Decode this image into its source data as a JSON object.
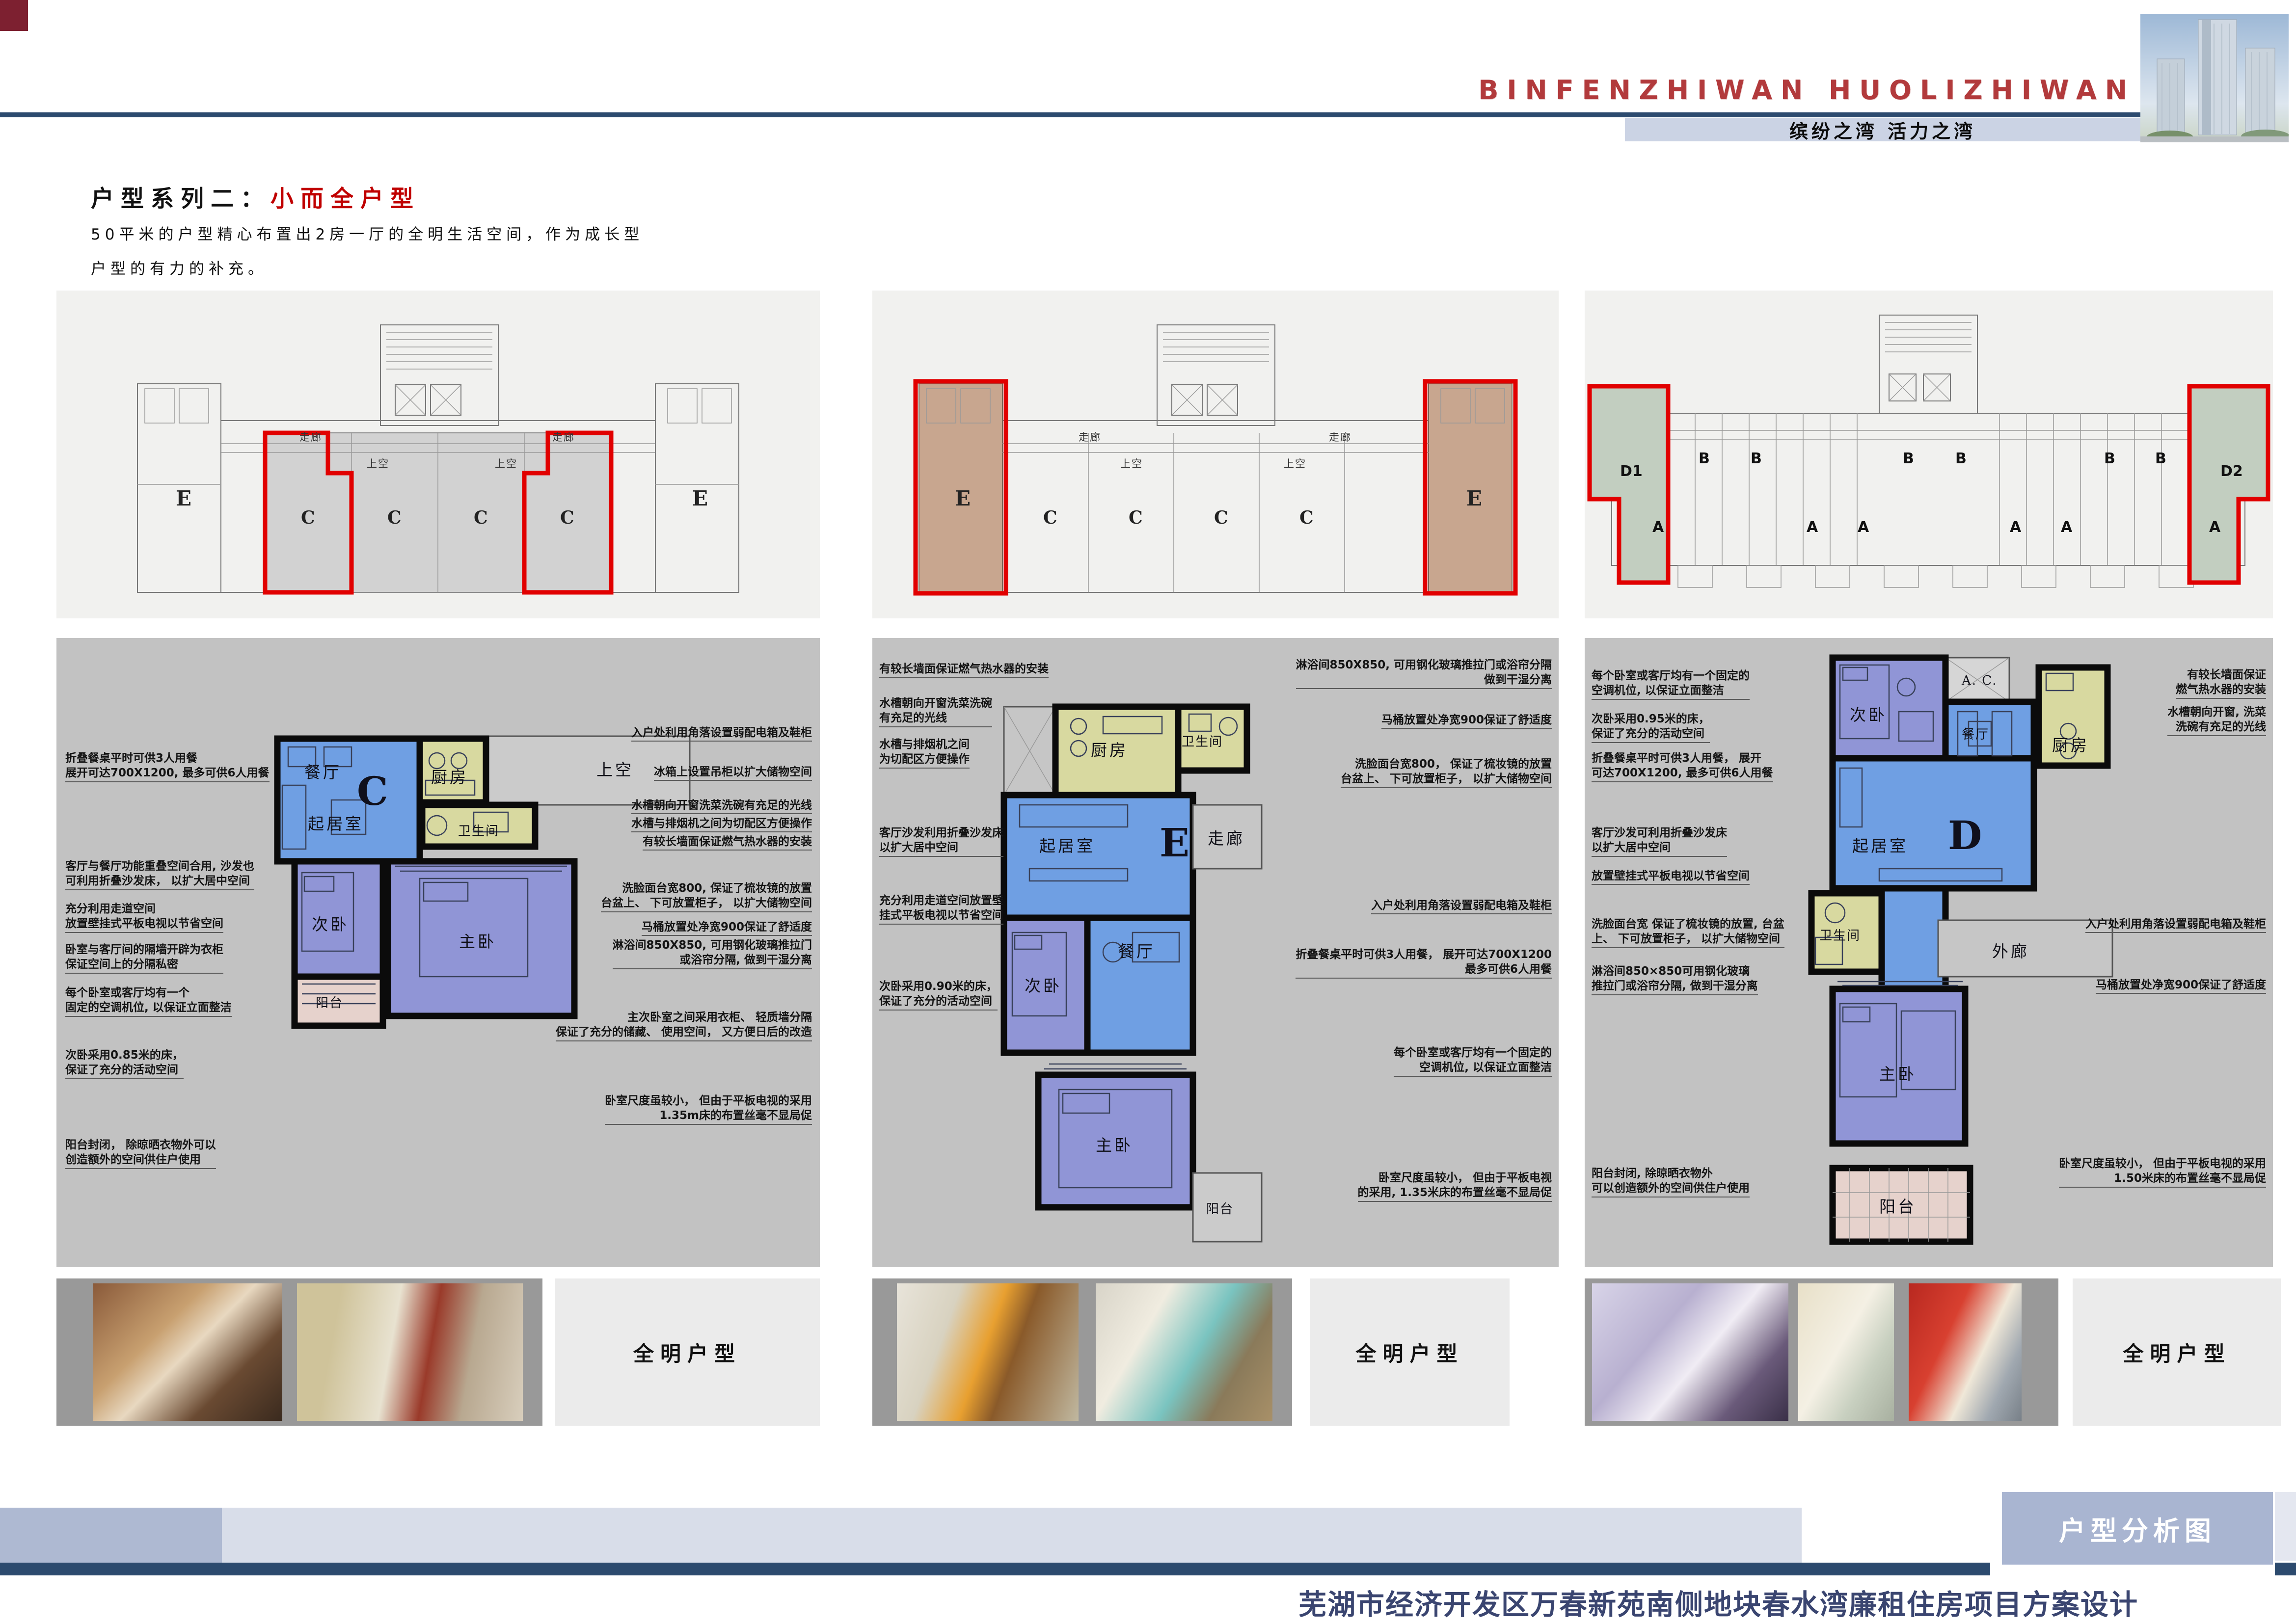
{
  "header": {
    "logo": "BINFENZHIWAN HUOLIZHIWAN",
    "tagline": "缤纷之湾  活力之湾",
    "accent_red": "#b23a3c",
    "navy": "#2c4a6e"
  },
  "title": {
    "series_label": "户型系列二：",
    "series_highlight": "小而全户型",
    "desc1": "50平米的户型精心布置出2房一厅的全明生活空间，作为成长型",
    "desc2": "户型的有力的补充。"
  },
  "site_plans": {
    "corridor": "走廊",
    "void_label": "上空",
    "plan_c_units": [
      "E",
      "C",
      "C",
      "C",
      "C",
      "E"
    ],
    "plan_e_units": [
      "E",
      "C",
      "C",
      "C",
      "C",
      "E"
    ],
    "plan_d": {
      "left": "D1",
      "right": "D2",
      "b": "B",
      "a": "A"
    }
  },
  "units": {
    "c": {
      "letter": "C",
      "rooms": {
        "dining": "餐厅",
        "living": "起居室",
        "kitchen": "厨房",
        "bath": "卫生间",
        "bed2": "次卧",
        "bed1": "主卧",
        "balcony": "阳台",
        "void_label": "上空"
      },
      "notes_left": [
        "折叠餐桌平时可供3人用餐\n展开可达700X1200, 最多可供6人用餐",
        "客厅与餐厅功能重叠空间合用, 沙发也\n可利用折叠沙发床， 以扩大居中空间",
        "充分利用走道空间\n放置壁挂式平板电视以节省空间",
        "卧室与客厅间的隔墙开辟为衣柜\n保证空间上的分隔私密",
        "每个卧室或客厅均有一个\n固定的空调机位, 以保证立面整洁",
        "次卧采用0.85米的床，\n保证了充分的活动空间",
        "阳台封闭， 除晾晒衣物外可以\n创造额外的空间供住户使用"
      ],
      "notes_right": [
        "入户处利用角落设置弱配电箱及鞋柜",
        "冰箱上设置吊柜以扩大储物空间",
        "水槽朝向开窗洗菜洗碗有充足的光线",
        "水槽与排烟机之间为切配区方便操作",
        "有较长墙面保证燃气热水器的安装",
        "洗脸面台宽800, 保证了梳妆镜的放置\n台盆上、 下可放置柜子， 以扩大储物空间",
        "马桶放置处净宽900保证了舒适度",
        "淋浴间850X850, 可用钢化玻璃推拉门\n或浴帘分隔, 做到干湿分离",
        "主次卧室之间采用衣柜、 轻质墙分隔\n保证了充分的储藏、 使用空间， 又方便日后的改造",
        "卧室尺度虽较小， 但由于平板电视的采用\n1.35m床的布置丝毫不显局促"
      ]
    },
    "e": {
      "letter": "E",
      "rooms": {
        "kitchen": "厨房",
        "bath": "卫生间",
        "living": "起居室",
        "corridor": "走廊",
        "bed2": "次卧",
        "dining": "餐厅",
        "bed1": "主卧",
        "balcony": "阳台"
      },
      "notes_left": [
        "有较长墙面保证燃气热水器的安装",
        "水槽朝向开窗洗菜洗碗\n有充足的光线",
        "水槽与排烟机之间\n为切配区方便操作",
        "客厅沙发利用折叠沙发床\n以扩大居中空间",
        "充分利用走道空间放置壁\n挂式平板电视以节省空间",
        "次卧采用0.90米的床，\n保证了充分的活动空间"
      ],
      "notes_right": [
        "淋浴间850X850, 可用钢化玻璃推拉门或浴帘分隔\n做到干湿分离",
        "马桶放置处净宽900保证了舒适度",
        "洗脸面台宽800， 保证了梳妆镜的放置\n台盆上、 下可放置柜子， 以扩大储物空间",
        "入户处利用角落设置弱配电箱及鞋柜",
        "折叠餐桌平时可供3人用餐， 展开可达700X1200\n最多可供6人用餐",
        "每个卧室或客厅均有一个固定的\n空调机位, 以保证立面整洁",
        "卧室尺度虽较小， 但由于平板电视\n的采用, 1.35米床的布置丝毫不显局促"
      ]
    },
    "d": {
      "letter": "D",
      "rooms": {
        "bed2": "次卧",
        "ac": "A. C.",
        "dining": "餐厅",
        "kitchen": "厨房",
        "living": "起居室",
        "outer_corridor": "外廊",
        "bath": "卫生间",
        "bed1": "主卧",
        "balcony": "阳台"
      },
      "notes_left": [
        "每个卧室或客厅均有一个固定的\n空调机位, 以保证立面整洁",
        "次卧采用0.95米的床，\n保证了充分的活动空间",
        "折叠餐桌平时可供3人用餐， 展开\n可达700X1200, 最多可供6人用餐",
        "客厅沙发可利用折叠沙发床\n以扩大居中空间",
        "放置壁挂式平板电视以节省空间",
        "洗脸面台宽 保证了梳妆镜的放置, 台盆\n上、 下可放置柜子， 以扩大储物空间",
        "淋浴间850×850可用钢化玻璃\n推拉门或浴帘分隔, 做到干湿分离",
        "阳台封闭, 除晾晒衣物外\n可以创造额外的空间供住户使用"
      ],
      "notes_right": [
        "有较长墙面保证\n燃气热水器的安装",
        "水槽朝向开窗, 洗菜\n洗碗有充足的光线",
        "入户处利用角落设置弱配电箱及鞋柜",
        "马桶放置处净宽900保证了舒适度",
        "卧室尺度虽较小， 但由于平板电视的采用\n1.50米床的布置丝毫不显局促"
      ]
    }
  },
  "photos_caption": "全明户型",
  "footer": {
    "tab": "户型分析图",
    "project": "芜湖市经济开发区万春新苑南侧地块春水湾廉租住房项目方案设计"
  }
}
